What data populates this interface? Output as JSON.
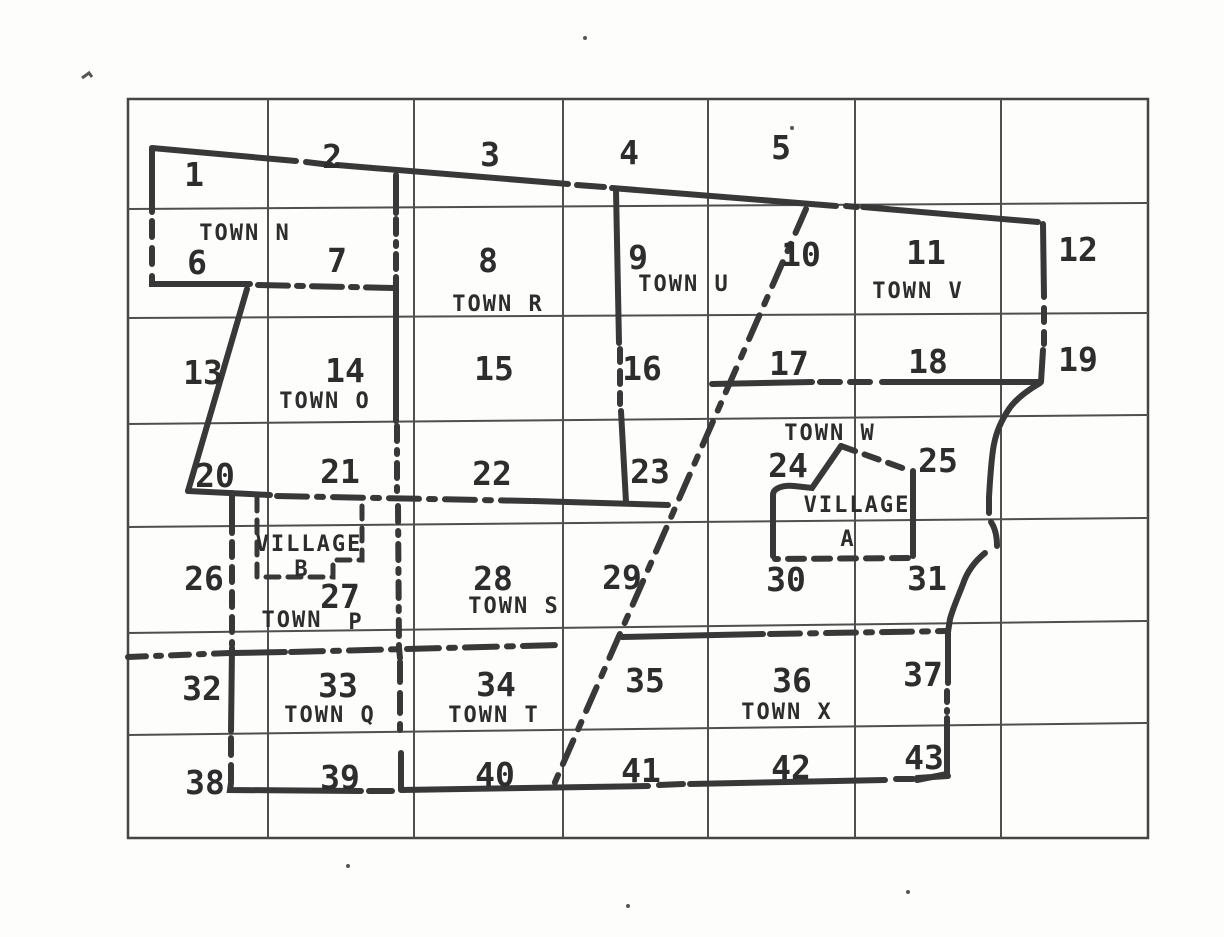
{
  "map": {
    "description": "Scanned county grid map with numbered sections, town and village boundaries",
    "ink_color": "#383838",
    "paper_color": "#fdfdfb",
    "labels": [
      {
        "text": "1",
        "x": 194,
        "y": 186,
        "cls": "num",
        "name": "section-number-1"
      },
      {
        "text": "2",
        "x": 332,
        "y": 168,
        "cls": "num",
        "name": "section-number-2"
      },
      {
        "text": "3",
        "x": 490,
        "y": 166,
        "cls": "num",
        "name": "section-number-3"
      },
      {
        "text": "4",
        "x": 629,
        "y": 164,
        "cls": "num",
        "name": "section-number-4"
      },
      {
        "text": "5",
        "x": 781,
        "y": 159,
        "cls": "num",
        "name": "section-number-5"
      },
      {
        "text": "6",
        "x": 197,
        "y": 274,
        "cls": "num",
        "name": "section-number-6"
      },
      {
        "text": "7",
        "x": 337,
        "y": 272,
        "cls": "num",
        "name": "section-number-7"
      },
      {
        "text": "8",
        "x": 488,
        "y": 272,
        "cls": "num",
        "name": "section-number-8"
      },
      {
        "text": "9",
        "x": 638,
        "y": 269,
        "cls": "num",
        "name": "section-number-9"
      },
      {
        "text": "10",
        "x": 801,
        "y": 266,
        "cls": "num",
        "name": "section-number-10"
      },
      {
        "text": "11",
        "x": 926,
        "y": 264,
        "cls": "num",
        "name": "section-number-11"
      },
      {
        "text": "12",
        "x": 1078,
        "y": 261,
        "cls": "num",
        "name": "section-number-12"
      },
      {
        "text": "13",
        "x": 203,
        "y": 384,
        "cls": "num",
        "name": "section-number-13"
      },
      {
        "text": "14",
        "x": 345,
        "y": 382,
        "cls": "num",
        "name": "section-number-14"
      },
      {
        "text": "15",
        "x": 494,
        "y": 380,
        "cls": "num",
        "name": "section-number-15"
      },
      {
        "text": "16",
        "x": 642,
        "y": 380,
        "cls": "num",
        "name": "section-number-16"
      },
      {
        "text": "17",
        "x": 789,
        "y": 375,
        "cls": "num",
        "name": "section-number-17"
      },
      {
        "text": "18",
        "x": 928,
        "y": 373,
        "cls": "num",
        "name": "section-number-18"
      },
      {
        "text": "19",
        "x": 1078,
        "y": 371,
        "cls": "num",
        "name": "section-number-19"
      },
      {
        "text": "20",
        "x": 215,
        "y": 487,
        "cls": "num",
        "name": "section-number-20"
      },
      {
        "text": "21",
        "x": 340,
        "y": 483,
        "cls": "num",
        "name": "section-number-21"
      },
      {
        "text": "22",
        "x": 492,
        "y": 485,
        "cls": "num",
        "name": "section-number-22"
      },
      {
        "text": "23",
        "x": 650,
        "y": 483,
        "cls": "num",
        "name": "section-number-23"
      },
      {
        "text": "24",
        "x": 788,
        "y": 477,
        "cls": "num",
        "name": "section-number-24"
      },
      {
        "text": "25",
        "x": 938,
        "y": 472,
        "cls": "num",
        "name": "section-number-25"
      },
      {
        "text": "26",
        "x": 204,
        "y": 590,
        "cls": "num",
        "name": "section-number-26"
      },
      {
        "text": "27",
        "x": 340,
        "y": 608,
        "cls": "num",
        "name": "section-number-27"
      },
      {
        "text": "28",
        "x": 493,
        "y": 590,
        "cls": "num",
        "name": "section-number-28"
      },
      {
        "text": "29",
        "x": 622,
        "y": 589,
        "cls": "num",
        "name": "section-number-29"
      },
      {
        "text": "30",
        "x": 786,
        "y": 591,
        "cls": "num",
        "name": "section-number-30"
      },
      {
        "text": "31",
        "x": 927,
        "y": 590,
        "cls": "num",
        "name": "section-number-31"
      },
      {
        "text": "32",
        "x": 202,
        "y": 700,
        "cls": "num",
        "name": "section-number-32"
      },
      {
        "text": "33",
        "x": 338,
        "y": 697,
        "cls": "num",
        "name": "section-number-33"
      },
      {
        "text": "34",
        "x": 496,
        "y": 696,
        "cls": "num",
        "name": "section-number-34"
      },
      {
        "text": "35",
        "x": 645,
        "y": 692,
        "cls": "num",
        "name": "section-number-35"
      },
      {
        "text": "36",
        "x": 792,
        "y": 692,
        "cls": "num",
        "name": "section-number-36"
      },
      {
        "text": "37",
        "x": 923,
        "y": 686,
        "cls": "num",
        "name": "section-number-37"
      },
      {
        "text": "38",
        "x": 205,
        "y": 794,
        "cls": "num",
        "name": "section-number-38"
      },
      {
        "text": "39",
        "x": 340,
        "y": 789,
        "cls": "num",
        "name": "section-number-39"
      },
      {
        "text": "40",
        "x": 495,
        "y": 786,
        "cls": "num",
        "name": "section-number-40"
      },
      {
        "text": "41",
        "x": 641,
        "y": 782,
        "cls": "num",
        "name": "section-number-41"
      },
      {
        "text": "42",
        "x": 791,
        "y": 779,
        "cls": "num",
        "name": "section-number-42"
      },
      {
        "text": "43",
        "x": 924,
        "y": 769,
        "cls": "num",
        "name": "section-number-43"
      },
      {
        "text": "TOWN N",
        "x": 245,
        "y": 240,
        "cls": "town",
        "name": "town-label-n"
      },
      {
        "text": "TOWN R",
        "x": 498,
        "y": 311,
        "cls": "town",
        "name": "town-label-r"
      },
      {
        "text": "TOWN U",
        "x": 684,
        "y": 291,
        "cls": "town",
        "name": "town-label-u"
      },
      {
        "text": "TOWN V",
        "x": 918,
        "y": 298,
        "cls": "town",
        "name": "town-label-v"
      },
      {
        "text": "TOWN O",
        "x": 325,
        "y": 408,
        "cls": "town",
        "name": "town-label-o"
      },
      {
        "text": "TOWN W",
        "x": 830,
        "y": 440,
        "cls": "town",
        "name": "town-label-w"
      },
      {
        "text": "TOWN S",
        "x": 514,
        "y": 613,
        "cls": "town",
        "name": "town-label-s"
      },
      {
        "text": "TOWN",
        "x": 292,
        "y": 627,
        "cls": "town",
        "name": "town-label-p-word"
      },
      {
        "text": "P",
        "x": 356,
        "y": 629,
        "cls": "town",
        "name": "town-label-p-letter"
      },
      {
        "text": "TOWN Q",
        "x": 330,
        "y": 722,
        "cls": "town",
        "name": "town-label-q"
      },
      {
        "text": "TOWN T",
        "x": 494,
        "y": 722,
        "cls": "town",
        "name": "town-label-t"
      },
      {
        "text": "TOWN X",
        "x": 787,
        "y": 719,
        "cls": "town",
        "name": "town-label-x"
      },
      {
        "text": "VILLAGE",
        "x": 309,
        "y": 551,
        "cls": "town",
        "name": "village-label-b-line1"
      },
      {
        "text": "B",
        "x": 302,
        "y": 576,
        "cls": "town",
        "name": "village-label-b-line2"
      },
      {
        "text": "VILLAGE",
        "x": 857,
        "y": 512,
        "cls": "town",
        "name": "village-label-a-line1"
      },
      {
        "text": "A",
        "x": 848,
        "y": 546,
        "cls": "town",
        "name": "village-label-a-line2"
      }
    ]
  }
}
